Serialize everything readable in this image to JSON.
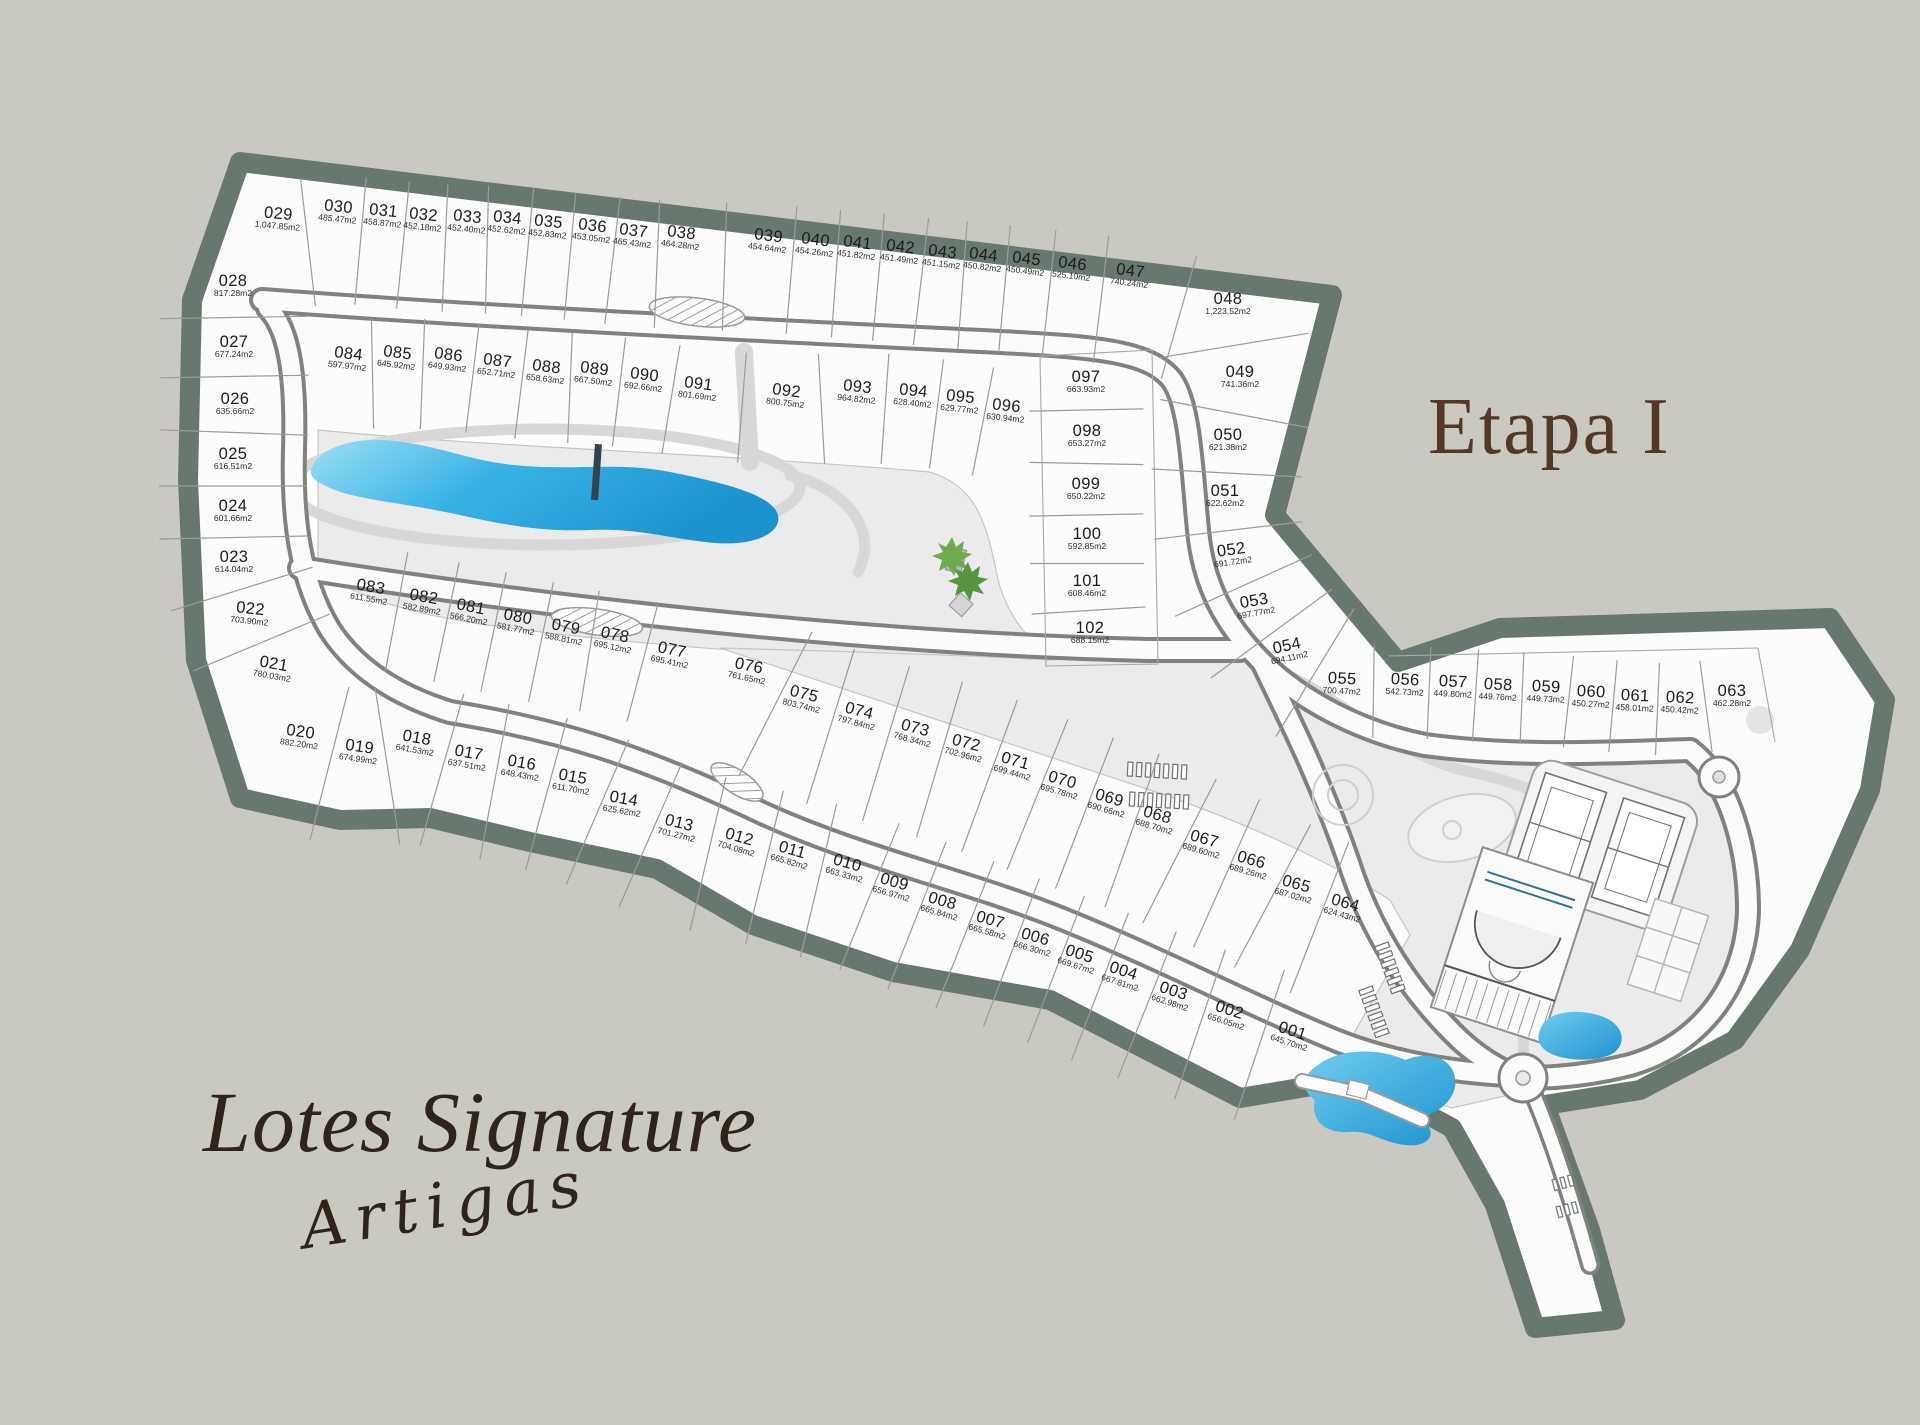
{
  "title": {
    "main": "Lotes Signature",
    "script": "Artigas"
  },
  "stage": "Etapa I",
  "colors": {
    "background": "#c9c9c1",
    "boundary_band": "#68786e",
    "site_fill": "#fcfcfc",
    "common_area": "#ebebeb",
    "road_edge": "#7e837c",
    "lake_blue_deep": "#1d93cd",
    "lake_blue_light": "#9ddff5",
    "title_brown": "#2e241c",
    "stage_brown": "#543827"
  },
  "lots": [
    {
      "id": "001",
      "area": "645.70m2",
      "x": 1291,
      "y": 1037,
      "r": 18
    },
    {
      "id": "002",
      "area": "656.05m2",
      "x": 1228,
      "y": 1016,
      "r": 18
    },
    {
      "id": "003",
      "area": "662.98m2",
      "x": 1172,
      "y": 997,
      "r": 18
    },
    {
      "id": "004",
      "area": "667.81m2",
      "x": 1122,
      "y": 977,
      "r": 18
    },
    {
      "id": "005",
      "area": "669.67m2",
      "x": 1078,
      "y": 960,
      "r": 18
    },
    {
      "id": "006",
      "area": "666.30m2",
      "x": 1034,
      "y": 943,
      "r": 16
    },
    {
      "id": "007",
      "area": "665.58m2",
      "x": 989,
      "y": 926,
      "r": 16
    },
    {
      "id": "008",
      "area": "665.84m2",
      "x": 941,
      "y": 907,
      "r": 16
    },
    {
      "id": "009",
      "area": "656.97m2",
      "x": 893,
      "y": 888,
      "r": 16
    },
    {
      "id": "010",
      "area": "663.33m2",
      "x": 846,
      "y": 869,
      "r": 16
    },
    {
      "id": "011",
      "area": "665.82m2",
      "x": 791,
      "y": 856,
      "r": 16
    },
    {
      "id": "012",
      "area": "704.08m2",
      "x": 738,
      "y": 843,
      "r": 16
    },
    {
      "id": "013",
      "area": "701.27m2",
      "x": 678,
      "y": 829,
      "r": 14
    },
    {
      "id": "014",
      "area": "625.62m2",
      "x": 623,
      "y": 805,
      "r": 10
    },
    {
      "id": "015",
      "area": "611.70m2",
      "x": 572,
      "y": 783,
      "r": 10
    },
    {
      "id": "016",
      "area": "648.43m2",
      "x": 521,
      "y": 769,
      "r": 10
    },
    {
      "id": "017",
      "area": "637.51m2",
      "x": 468,
      "y": 759,
      "r": 10
    },
    {
      "id": "018",
      "area": "641.53m2",
      "x": 416,
      "y": 744,
      "r": 10
    },
    {
      "id": "019",
      "area": "674.99m2",
      "x": 359,
      "y": 753,
      "r": 8
    },
    {
      "id": "020",
      "area": "882.20m2",
      "x": 300,
      "y": 738,
      "r": 8
    },
    {
      "id": "021",
      "area": "780.03m2",
      "x": 273,
      "y": 670,
      "r": 10
    },
    {
      "id": "022",
      "area": "703.90m2",
      "x": 250,
      "y": 615,
      "r": 6
    },
    {
      "id": "023",
      "area": "614.04m2",
      "x": 234,
      "y": 563,
      "r": 0
    },
    {
      "id": "024",
      "area": "601.66m2",
      "x": 233,
      "y": 512,
      "r": 0
    },
    {
      "id": "025",
      "area": "616.51m2",
      "x": 233,
      "y": 460,
      "r": 0
    },
    {
      "id": "026",
      "area": "635.66m2",
      "x": 235,
      "y": 405,
      "r": 0
    },
    {
      "id": "027",
      "area": "677.24m2",
      "x": 234,
      "y": 348,
      "r": 0
    },
    {
      "id": "028",
      "area": "817.28m2",
      "x": 233,
      "y": 287,
      "r": 0
    },
    {
      "id": "029",
      "area": "1,047.85m2",
      "x": 278,
      "y": 220,
      "r": 5
    },
    {
      "id": "030",
      "area": "485.47m2",
      "x": 338,
      "y": 213,
      "r": 6
    },
    {
      "id": "031",
      "area": "458.87m2",
      "x": 383,
      "y": 217,
      "r": 6
    },
    {
      "id": "032",
      "area": "452.18m2",
      "x": 423,
      "y": 221,
      "r": 6
    },
    {
      "id": "033",
      "area": "452.40m2",
      "x": 467,
      "y": 223,
      "r": 6
    },
    {
      "id": "034",
      "area": "452.62m2",
      "x": 507,
      "y": 224,
      "r": 6
    },
    {
      "id": "035",
      "area": "452.83m2",
      "x": 548,
      "y": 228,
      "r": 6
    },
    {
      "id": "036",
      "area": "453.05m2",
      "x": 592,
      "y": 232,
      "r": 7
    },
    {
      "id": "037",
      "area": "465.43m2",
      "x": 633,
      "y": 237,
      "r": 7
    },
    {
      "id": "038",
      "area": "464.28m2",
      "x": 681,
      "y": 239,
      "r": 7
    },
    {
      "id": "039",
      "area": "454.64m2",
      "x": 768,
      "y": 242,
      "r": 7
    },
    {
      "id": "040",
      "area": "454.26m2",
      "x": 815,
      "y": 246,
      "r": 7
    },
    {
      "id": "041",
      "area": "451.82m2",
      "x": 857,
      "y": 249,
      "r": 7
    },
    {
      "id": "042",
      "area": "451.49m2",
      "x": 900,
      "y": 253,
      "r": 7
    },
    {
      "id": "043",
      "area": "451.15m2",
      "x": 942,
      "y": 258,
      "r": 7
    },
    {
      "id": "044",
      "area": "450.82m2",
      "x": 983,
      "y": 261,
      "r": 7
    },
    {
      "id": "045",
      "area": "450.49m2",
      "x": 1026,
      "y": 265,
      "r": 7
    },
    {
      "id": "046",
      "area": "525.10m2",
      "x": 1072,
      "y": 270,
      "r": 7
    },
    {
      "id": "047",
      "area": "740.24m2",
      "x": 1130,
      "y": 277,
      "r": 7
    },
    {
      "id": "048",
      "area": "1,223.52m2",
      "x": 1228,
      "y": 305,
      "r": 0
    },
    {
      "id": "049",
      "area": "741.36m2",
      "x": 1240,
      "y": 378,
      "r": 0
    },
    {
      "id": "050",
      "area": "621.38m2",
      "x": 1228,
      "y": 441,
      "r": 0
    },
    {
      "id": "051",
      "area": "622.62m2",
      "x": 1225,
      "y": 497,
      "r": 0
    },
    {
      "id": "052",
      "area": "691.72m2",
      "x": 1232,
      "y": 556,
      "r": -8
    },
    {
      "id": "053",
      "area": "697.77m2",
      "x": 1255,
      "y": 607,
      "r": -10
    },
    {
      "id": "054",
      "area": "694.11m2",
      "x": 1288,
      "y": 652,
      "r": -12
    },
    {
      "id": "055",
      "area": "700.47m2",
      "x": 1342,
      "y": 685,
      "r": 3
    },
    {
      "id": "056",
      "area": "542.73m2",
      "x": 1405,
      "y": 686,
      "r": 3
    },
    {
      "id": "057",
      "area": "449.80m2",
      "x": 1453,
      "y": 688,
      "r": 3
    },
    {
      "id": "058",
      "area": "449.76m2",
      "x": 1498,
      "y": 691,
      "r": 3
    },
    {
      "id": "059",
      "area": "449.73m2",
      "x": 1546,
      "y": 693,
      "r": 3
    },
    {
      "id": "060",
      "area": "450.27m2",
      "x": 1591,
      "y": 698,
      "r": 3
    },
    {
      "id": "061",
      "area": "458.01m2",
      "x": 1635,
      "y": 702,
      "r": 3
    },
    {
      "id": "062",
      "area": "450.42m2",
      "x": 1680,
      "y": 704,
      "r": 3
    },
    {
      "id": "063",
      "area": "462.28m2",
      "x": 1732,
      "y": 697,
      "r": 0
    },
    {
      "id": "064",
      "area": "624.43m2",
      "x": 1344,
      "y": 909,
      "r": 16
    },
    {
      "id": "065",
      "area": "687.02m2",
      "x": 1295,
      "y": 890,
      "r": 16
    },
    {
      "id": "066",
      "area": "689.26m2",
      "x": 1250,
      "y": 866,
      "r": 16
    },
    {
      "id": "067",
      "area": "689.60m2",
      "x": 1203,
      "y": 845,
      "r": 16
    },
    {
      "id": "068",
      "area": "688.70m2",
      "x": 1156,
      "y": 821,
      "r": 16
    },
    {
      "id": "069",
      "area": "690.66m2",
      "x": 1108,
      "y": 804,
      "r": 16
    },
    {
      "id": "070",
      "area": "695.78m2",
      "x": 1061,
      "y": 786,
      "r": 16
    },
    {
      "id": "071",
      "area": "699.44m2",
      "x": 1014,
      "y": 767,
      "r": 16
    },
    {
      "id": "072",
      "area": "702.96m2",
      "x": 965,
      "y": 749,
      "r": 15
    },
    {
      "id": "073",
      "area": "768.34m2",
      "x": 914,
      "y": 734,
      "r": 15
    },
    {
      "id": "074",
      "area": "797.84m2",
      "x": 858,
      "y": 717,
      "r": 15
    },
    {
      "id": "075",
      "area": "803.74m2",
      "x": 803,
      "y": 700,
      "r": 14
    },
    {
      "id": "076",
      "area": "761.65m2",
      "x": 748,
      "y": 672,
      "r": 12
    },
    {
      "id": "077",
      "area": "695.41m2",
      "x": 671,
      "y": 656,
      "r": 12
    },
    {
      "id": "078",
      "area": "695.12m2",
      "x": 614,
      "y": 641,
      "r": 12
    },
    {
      "id": "079",
      "area": "588.81m2",
      "x": 565,
      "y": 633,
      "r": 11
    },
    {
      "id": "080",
      "area": "581.77m2",
      "x": 517,
      "y": 623,
      "r": 11
    },
    {
      "id": "081",
      "area": "566.20m2",
      "x": 470,
      "y": 613,
      "r": 11
    },
    {
      "id": "082",
      "area": "582.89m2",
      "x": 423,
      "y": 603,
      "r": 10
    },
    {
      "id": "083",
      "area": "611.55m2",
      "x": 370,
      "y": 593,
      "r": 10
    },
    {
      "id": "084",
      "area": "597.97m2",
      "x": 348,
      "y": 360,
      "r": 7
    },
    {
      "id": "085",
      "area": "645.92m2",
      "x": 397,
      "y": 359,
      "r": 7
    },
    {
      "id": "086",
      "area": "649.93m2",
      "x": 448,
      "y": 361,
      "r": 7
    },
    {
      "id": "087",
      "area": "652.71m2",
      "x": 497,
      "y": 367,
      "r": 7
    },
    {
      "id": "088",
      "area": "658.63m2",
      "x": 546,
      "y": 373,
      "r": 7
    },
    {
      "id": "089",
      "area": "667.50m2",
      "x": 594,
      "y": 375,
      "r": 7
    },
    {
      "id": "090",
      "area": "692.66m2",
      "x": 644,
      "y": 381,
      "r": 7
    },
    {
      "id": "091",
      "area": "801.69m2",
      "x": 698,
      "y": 390,
      "r": 7
    },
    {
      "id": "092",
      "area": "800.75m2",
      "x": 786,
      "y": 397,
      "r": 7
    },
    {
      "id": "093",
      "area": "964.82m2",
      "x": 857,
      "y": 393,
      "r": 6
    },
    {
      "id": "094",
      "area": "628.40m2",
      "x": 913,
      "y": 397,
      "r": 6
    },
    {
      "id": "095",
      "area": "629.77m2",
      "x": 960,
      "y": 403,
      "r": 6
    },
    {
      "id": "096",
      "area": "630.94m2",
      "x": 1006,
      "y": 412,
      "r": 6
    },
    {
      "id": "097",
      "area": "663.93m2",
      "x": 1086,
      "y": 383,
      "r": 0
    },
    {
      "id": "098",
      "area": "653.27m2",
      "x": 1087,
      "y": 437,
      "r": 0
    },
    {
      "id": "099",
      "area": "650.22m2",
      "x": 1086,
      "y": 490,
      "r": 0
    },
    {
      "id": "100",
      "area": "592.85m2",
      "x": 1087,
      "y": 540,
      "r": 0
    },
    {
      "id": "101",
      "area": "608.46m2",
      "x": 1087,
      "y": 587,
      "r": 0
    },
    {
      "id": "102",
      "area": "688.15m2",
      "x": 1090,
      "y": 634,
      "r": 0
    }
  ],
  "divider_rows": [
    {
      "ids": [
        "029",
        "030",
        "031",
        "032",
        "033",
        "034",
        "035",
        "036",
        "037",
        "038",
        "039",
        "040",
        "041",
        "042",
        "043",
        "044",
        "045",
        "046",
        "047",
        "048"
      ],
      "len": 128,
      "dy": 26
    },
    {
      "ids": [
        "028",
        "027",
        "026",
        "025",
        "024",
        "023",
        "022",
        "021"
      ],
      "len": 148,
      "dy": 0
    },
    {
      "ids": [
        "084",
        "085",
        "086",
        "087",
        "088",
        "089",
        "090",
        "091",
        "092",
        "093",
        "094",
        "095",
        "096"
      ],
      "len": 110,
      "dy": 14
    },
    {
      "ids": [
        "097",
        "098",
        "099",
        "100",
        "101",
        "102"
      ],
      "len": 114,
      "dy": 0
    },
    {
      "ids": [
        "048",
        "049",
        "050",
        "051",
        "052",
        "053",
        "054",
        "055"
      ],
      "len": 150,
      "dy": 4
    },
    {
      "ids": [
        "055",
        "056",
        "057",
        "058",
        "059",
        "060",
        "061",
        "062",
        "063"
      ],
      "len": 92,
      "dy": 6
    },
    {
      "ids": [
        "083",
        "082",
        "081",
        "080",
        "079",
        "078",
        "077"
      ],
      "len": 122,
      "dy": 14
    },
    {
      "ids": [
        "076",
        "075",
        "074",
        "073",
        "072",
        "071",
        "070",
        "069",
        "068",
        "067",
        "066",
        "065",
        "064"
      ],
      "len": 162,
      "dy": 18
    },
    {
      "ids": [
        "020",
        "019",
        "018",
        "017",
        "016",
        "015",
        "014",
        "013",
        "012",
        "011",
        "010",
        "009",
        "008",
        "007",
        "006",
        "005",
        "004",
        "003",
        "002",
        "001"
      ],
      "len": 158,
      "dy": 18
    }
  ]
}
